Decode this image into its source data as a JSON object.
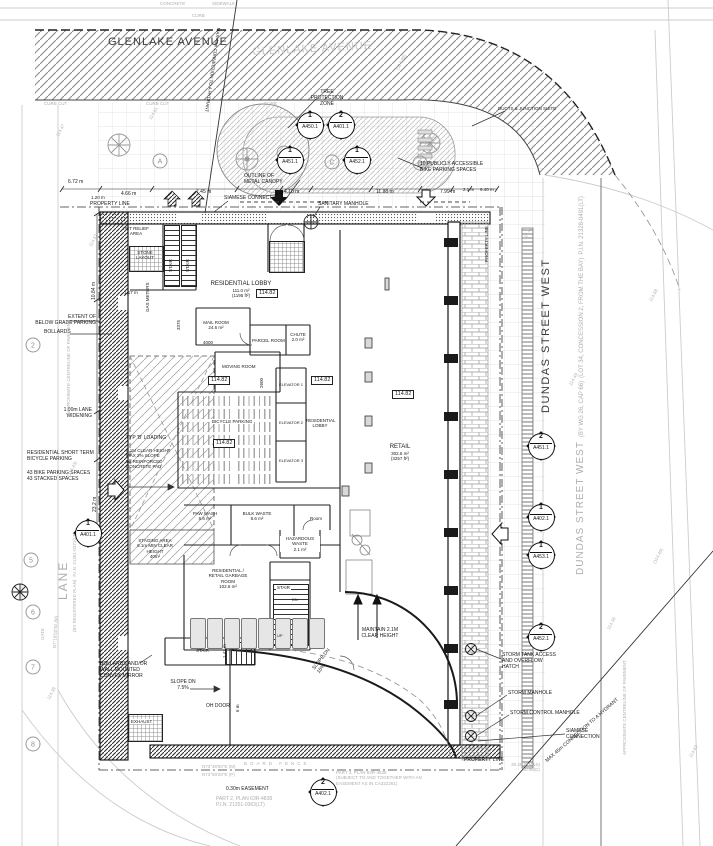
{
  "streets": {
    "glenlake": "GLENLAKE AVENUE",
    "dundas": "DUNDAS STREET WEST",
    "dundas_legal": [
      "DUNDAS STREET WEST",
      "(BY WG 26, CAP 66)",
      "(LOT 34, CONCESSION 2, FROM THE BAY)",
      "P.I.N. 21328-0491(LT)"
    ],
    "lane": "LANE",
    "lane_legal": [
      "(BY REGISTERED PLAN)",
      "P.I.N. 21351-0371(LT)"
    ]
  },
  "markers": [
    {
      "num": "1",
      "sheet": "A450.1"
    },
    {
      "num": "2",
      "sheet": "A401.1"
    },
    {
      "num": "1",
      "sheet": "A451.1"
    },
    {
      "num": "1",
      "sheet": "A452.1"
    },
    {
      "num": "2",
      "sheet": "A451.1"
    },
    {
      "num": "1",
      "sheet": "A402.1"
    },
    {
      "num": "1",
      "sheet": "A453.1"
    },
    {
      "num": "2",
      "sheet": "A452.1"
    },
    {
      "num": "1",
      "sheet": "A401.1"
    },
    {
      "num": "2",
      "sheet": "A402.1"
    }
  ],
  "bubbles": {
    "a": "A",
    "c": "C",
    "d": "D",
    "n2": "2",
    "n5": "5",
    "n6": "6",
    "n7": "7",
    "n8": "8"
  },
  "rooms": {
    "pet": [
      "PET RELIEF",
      "AREA"
    ],
    "stone": [
      "STONE",
      "LAYOUT"
    ],
    "stair": "STAIR",
    "lobby": [
      "RESIDENTIAL LOBBY",
      "111.0 m²",
      "(1195 ft²)"
    ],
    "mail": [
      "MAIL ROOM",
      "24.6 m²"
    ],
    "parcel": "PARCEL ROOM",
    "chute": [
      "CHUTE",
      "2.0 m²"
    ],
    "moving": "MOVING ROOM",
    "bicycle": "BICYCLE PARKING",
    "elevators": [
      "ELEVATOR 1",
      "ELEVATOR 2",
      "ELEVATOR 3"
    ],
    "lobby2": [
      "RESIDENTIAL",
      "LOBBY"
    ],
    "paw": [
      "PAW WASH",
      "6.6 m²"
    ],
    "bulk": [
      "BULK WASTE",
      "8.6 m²"
    ],
    "room": "Room",
    "haz": [
      "HAZARDOUS",
      "WASTE",
      "2.1 m²"
    ],
    "garbage": [
      "RESIDENTIAL /",
      "RETAIL GARBAGE",
      "ROOM",
      "102.6 m²"
    ],
    "retail": [
      "RETAIL",
      "302.6 m²",
      "(3257 ft²)"
    ],
    "exhaust": "EXHAUST"
  },
  "elevation": "114.82",
  "notes": {
    "property_line": "PROPERTY LINE",
    "siamese_line": "SIAMESE CONNECTION",
    "siamese": [
      "SIAMESE",
      "CONNECTION"
    ],
    "sanitary": "SANITARY MANHOLE",
    "canopy": [
      "OUTLINE OF",
      "METAL CANOPY"
    ],
    "tpz": [
      "TREE",
      "PROTECTION",
      "ZONE"
    ],
    "bike10": [
      "10 PUBLICLY ACCESSIBLE",
      "BIKE PARKING SPACES"
    ],
    "ducts": "DUCTS & JUNCTION SUITE",
    "hydrant": "MAX 45m CONNECTION TO A HYDRANT",
    "extent": [
      "EXTENT OF",
      "BELOW GRADE PARKING"
    ],
    "bollards": "BOLLARDS",
    "lane_widening": [
      "1.00m LANE",
      "WIDENING"
    ],
    "short_term": [
      "RESIDENTIAL SHORT TERM",
      "BICYCLE PARKING"
    ],
    "bike43": [
      "43 BIKE PARKING SPACES",
      "43 STACKED SPACES"
    ],
    "typ_b": "TYP 'B' LOADING",
    "typ_b_notes": [
      "6.1M CLEAR HEIGHT",
      "MAX 2% SLOPE",
      "W/ REINFORCED",
      "CONCRETE PAD"
    ],
    "staging": [
      "STAGING AREA",
      "6.1m MIN CLEAR",
      "HEIGHT",
      "40m²"
    ],
    "mirror": [
      "BOLLARDS AND/OR",
      "WALL MOUNTED",
      "CONVEX MIRROR"
    ],
    "slope75": [
      "SLOPE DN",
      "7.5%"
    ],
    "oh_door": "OH DOOR",
    "slope15": [
      "SLOPE DN",
      "15%"
    ],
    "maintain": [
      "MAINTAIN 2.1M",
      "CLEAR HEIGHT"
    ],
    "storm_hatch": [
      "STORM TANK ACCESS",
      "AND OVERFLOW",
      "HATCH"
    ],
    "storm_mh": "STORM MANHOLE",
    "storm_cmh": "STORM CONTROL MANHOLE",
    "board_fence": "BOARD FENCE",
    "bearing_m": "N73°48'50\"E (M)",
    "bearing_p": "N73°50'20\"E (P)",
    "bearing_lane": "N7°18'50\"W (M)",
    "easement": "0.30m EASEMENT",
    "part2": [
      "PART 2, PLAN 63R-4838",
      "P.I.N. 21351-0363(LT)"
    ],
    "part3": [
      "PART 3, PLAN 63R-4838",
      "(SUBJECT TO AND TOGETHER WITH AN",
      "EASEMENT AS IN CA322261)"
    ],
    "dist3048": [
      "30.48 (P,M&S)",
      "30.48(D)"
    ],
    "approx_cl": "APPROXIMATE CENTRELINE OF PAVEMENT",
    "concrete": "CONCRETE",
    "sidewalk": "SIDEWALK",
    "curb": "CURB",
    "curb_cut": "CURB CUT",
    "gate": "GATE",
    "gas_meters": "GAS METERS",
    "up": "UP",
    "dn": "DN"
  },
  "dims": {
    "d672": "6.72 m",
    "d120": "1.20 m",
    "d466": "4.66 m",
    "d745": "7.45 m",
    "d410": "4.10 m",
    "d1198": "11.98 m",
    "d799": "7.99 m",
    "d21": "2.1 m",
    "d640": "6.40 m",
    "d2320": "23.2 m",
    "d1084": "10.84 m",
    "d117": "1.17 m",
    "d3375": "3375",
    "d4000": "4000",
    "d2600": "2600",
    "d147": "1.47 m",
    "d6": "6 m"
  },
  "spots": [
    "114.47",
    "114.52",
    "(114.43)",
    "114.38",
    "114.61",
    "(114.55)",
    "114.44",
    "114.49",
    "114.58",
    "(114.40)",
    "114.36",
    "114.63"
  ]
}
